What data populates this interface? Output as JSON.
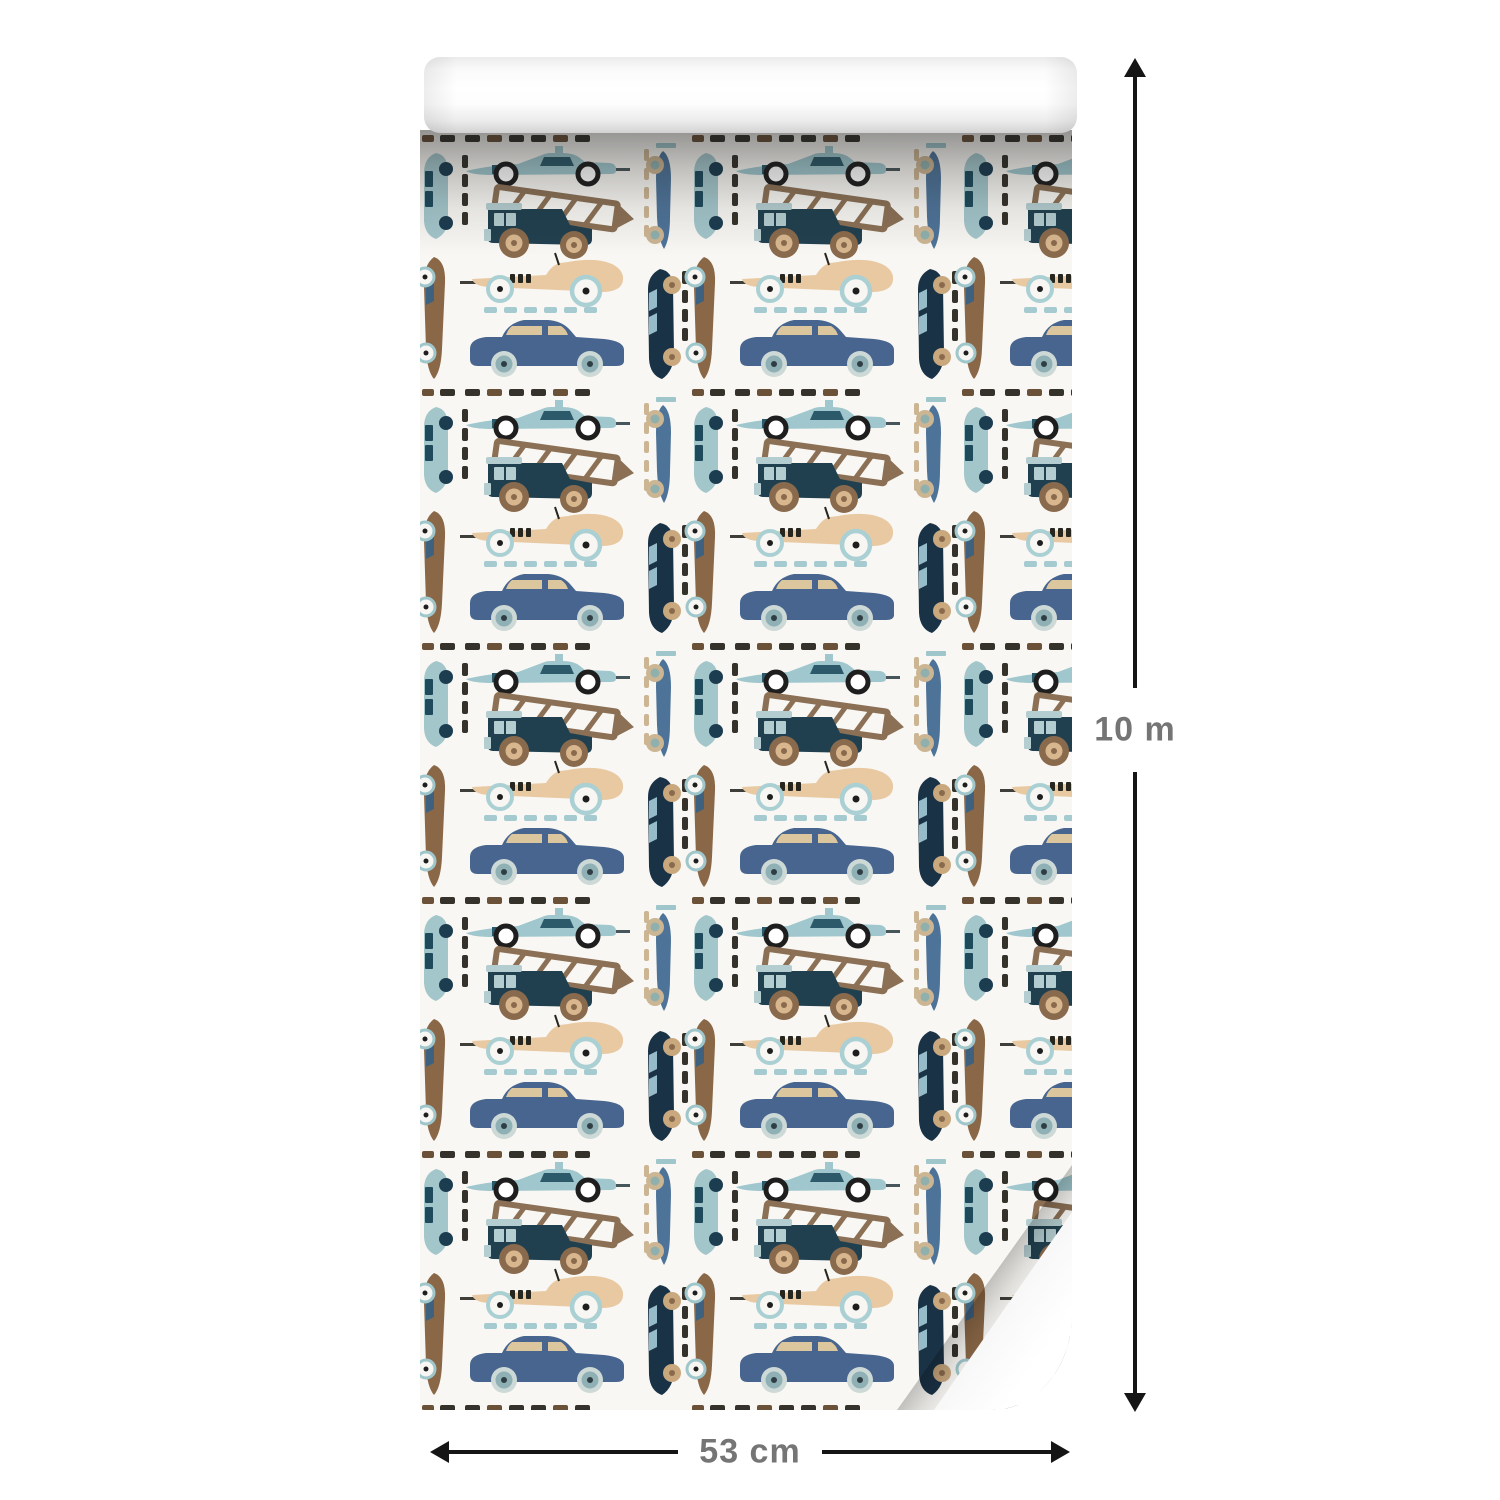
{
  "product_image": {
    "subject": "children's wallpaper roll with retro toy vehicles pattern",
    "dimensions": {
      "length_label": "10 m",
      "width_label": "53 cm"
    },
    "pattern_motifs": [
      "formula-race-car",
      "dump-truck",
      "vintage-roadster",
      "classic-sedan",
      "race-car-vertical",
      "sedan-vertical",
      "wagon-vertical-teal",
      "roadster-vertical-brown",
      "dashed-road-lines"
    ],
    "palette": {
      "paper_white": "#f8f7f3",
      "steel_blue": "#47658e",
      "light_teal": "#9fc7cd",
      "dark_teal": "#2c5a6a",
      "navy": "#1a3246",
      "tan": "#e9c9a2",
      "brown": "#8a6746",
      "wood_brown": "#8b7055",
      "sand": "#ccb593",
      "charcoal": "#35322b",
      "label_gray": "#757575",
      "arrow_black": "#151515"
    }
  }
}
